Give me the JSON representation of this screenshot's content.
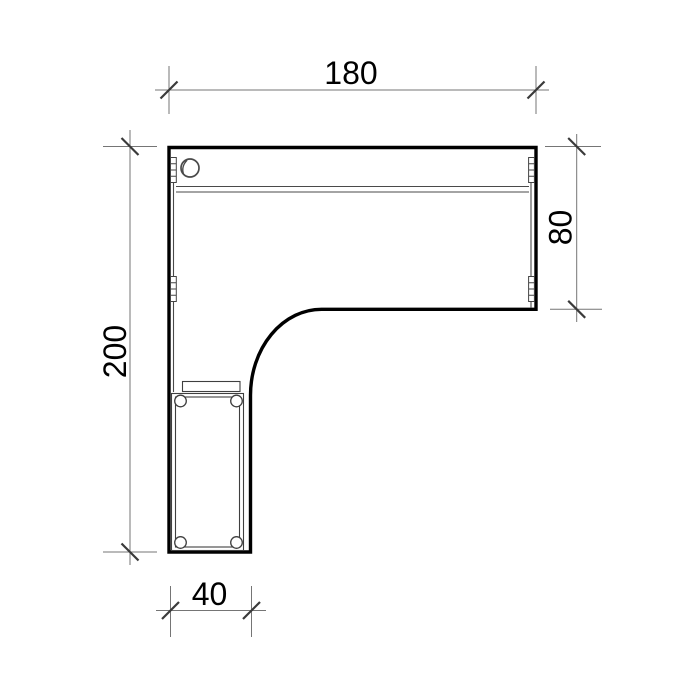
{
  "drawing": {
    "subject": "l-shaped-desk-top-view",
    "dimensions": {
      "top": {
        "label": "180",
        "value": 180
      },
      "right": {
        "label": "80",
        "value": 80
      },
      "left": {
        "label": "200",
        "value": 200
      },
      "bottom": {
        "label": "40",
        "value": 40
      }
    },
    "colors": {
      "background": "#ffffff",
      "outline": "#000000",
      "detail_line": "#3f3f3f",
      "dimension_line": "#757575",
      "tick": "#3a3a3a",
      "text": "#000000"
    }
  }
}
